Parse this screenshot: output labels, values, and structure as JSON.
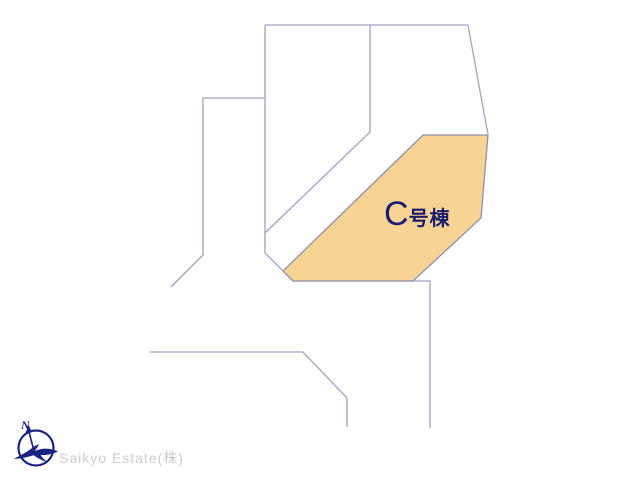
{
  "plan": {
    "background": "#ffffff",
    "line_color": "#a0a2c4",
    "canvas_size": [
      640,
      480
    ],
    "boundaries": [
      [
        [
          265,
          25
        ],
        [
          468,
          25
        ],
        [
          484,
          113
        ],
        [
          488,
          134
        ]
      ],
      [
        [
          370,
          25
        ],
        [
          370,
          132
        ],
        [
          265,
          233
        ]
      ],
      [
        [
          265,
          25
        ],
        [
          265,
          253
        ],
        [
          293,
          281
        ],
        [
          430,
          281
        ],
        [
          430,
          428
        ]
      ],
      [
        [
          265,
          98
        ],
        [
          203,
          98
        ],
        [
          203,
          255
        ],
        [
          171,
          287
        ]
      ],
      [
        [
          150,
          352
        ],
        [
          303,
          352
        ],
        [
          347,
          398
        ],
        [
          347,
          427
        ]
      ]
    ],
    "highlight": {
      "name": "C号棟",
      "letter": "C",
      "suffix": "号棟",
      "fill": "#F7D494",
      "stroke": "#8f8fae",
      "label_color": "#1a1a6e",
      "polygon": [
        [
          423,
          135
        ],
        [
          488,
          135
        ],
        [
          481,
          218
        ],
        [
          413,
          281
        ],
        [
          293,
          281
        ],
        [
          283,
          271
        ]
      ]
    }
  },
  "footer": {
    "company": "Saikyo Estate(株)",
    "text_color": "#cccccc",
    "logo": "compass-bird-logo",
    "logo_color": "#1b2380",
    "logo_north_label": "N"
  }
}
